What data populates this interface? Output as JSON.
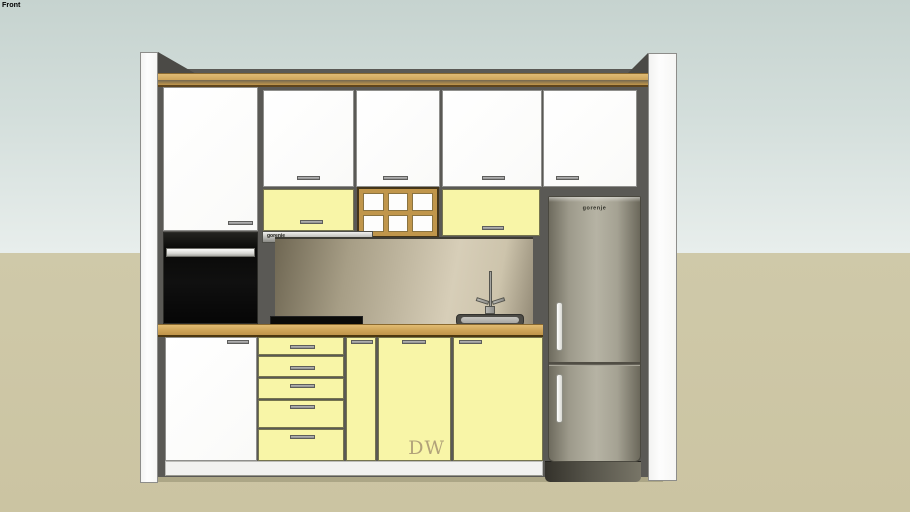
{
  "viewport": {
    "scene_label": "Front"
  },
  "model": {
    "hood": {
      "brand": "gorenje"
    },
    "fridge": {
      "brand": "gorenje"
    },
    "dishwasher": {
      "label": "DW"
    }
  },
  "colors": {
    "sky_top": "#c6d3cf",
    "sky_bottom": "#e8eeec",
    "ground": "#cfc9a9",
    "wall_panel": "#5a5955",
    "cabinet_white": "#fcfcfc",
    "cabinet_yellow": "#f8f5a7",
    "wood_trim": "#cda45a",
    "countertop_wood": "#cba155",
    "oven_black": "#0b0b09",
    "fridge_gray": "#b6b3a4",
    "backsplash_beige": "#d7ceb8"
  }
}
